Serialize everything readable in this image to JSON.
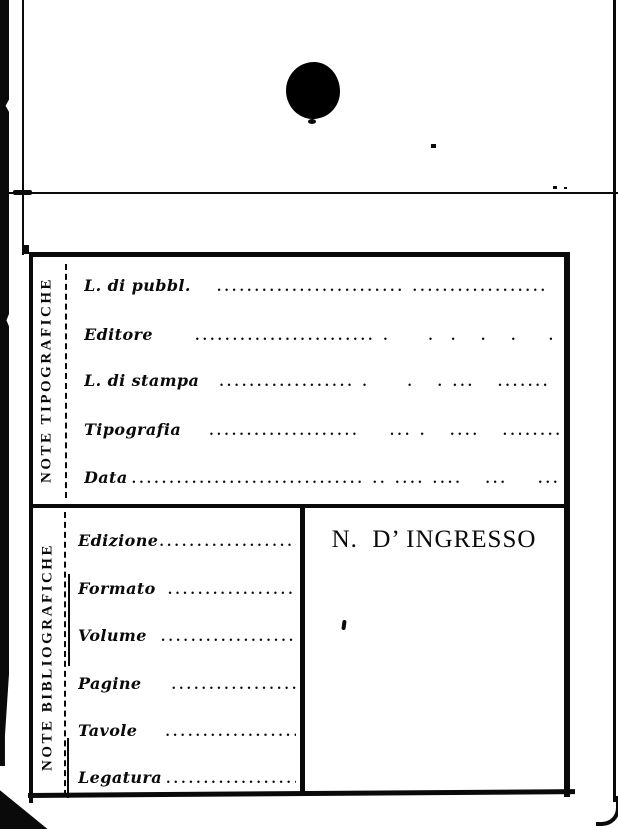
{
  "card": {
    "sections": [
      {
        "side_label": "NOTE TIPOGRAFICHE",
        "fields": [
          {
            "label": "L. di pubbl.",
            "leader": "......................... ..................     .  . .    . ."
          },
          {
            "label": "Editore",
            "leader": "........................ .     .  .   .   .    . .       .   .   .   ."
          },
          {
            "label": "L. di stampa",
            "leader": ".................. .     .   . ...   .......  . ........"
          },
          {
            "label": "Tipografia",
            "leader": "....................    ... .   ....   .........        ."
          },
          {
            "label": "Data",
            "leader": "............................... .. .... ....   ...    ...      ."
          }
        ]
      },
      {
        "side_label": "NOTE BIBLIOGRAFICHE",
        "fields": [
          {
            "label": "Edizione",
            "leader": "........................"
          },
          {
            "label": "Formato",
            "leader": "......................."
          },
          {
            "label": "Volume",
            "leader": "......................."
          },
          {
            "label": "Pagine",
            "leader": "...................."
          },
          {
            "label": "Tavole",
            "leader": "...................."
          },
          {
            "label": "Legatura",
            "leader": "......................"
          }
        ],
        "ingresso": "N.  D’ INGRESSO"
      }
    ]
  }
}
